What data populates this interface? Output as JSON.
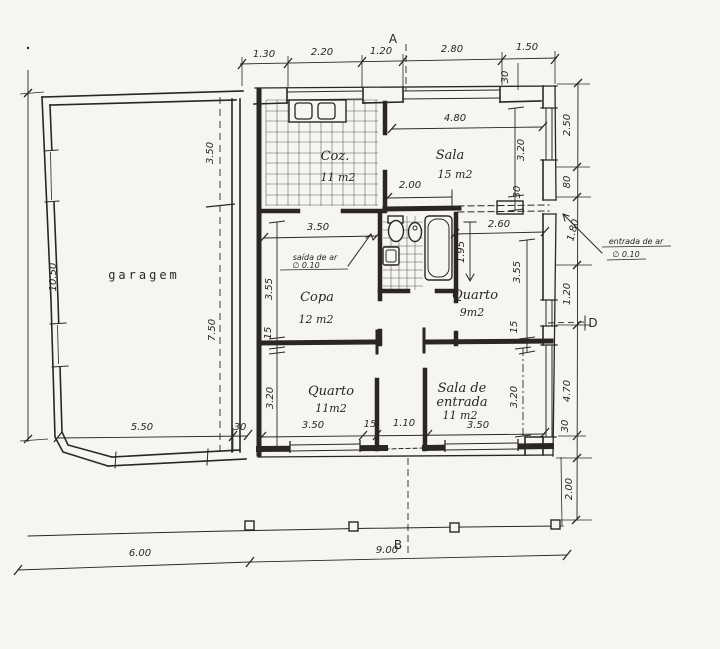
{
  "sheet": {
    "background": "#f6f5f0",
    "ink": "#2a2722"
  },
  "markers": {
    "a": "A",
    "b": "B",
    "d": "D"
  },
  "rooms": {
    "garagem": {
      "name": "garagem"
    },
    "coz": {
      "name": "Coz.",
      "area": "11 m2"
    },
    "sala": {
      "name": "Sala",
      "area": "15 m2"
    },
    "copa": {
      "name": "Copa",
      "area": "12 m2"
    },
    "quarto9": {
      "name": "Quarto",
      "area": "9m2"
    },
    "quarto11": {
      "name": "Quarto",
      "area": "11m2"
    },
    "sala_entrada": {
      "name_line1": "Sala de",
      "name_line2": "entrada",
      "area": "11 m2"
    }
  },
  "vents": {
    "saida_label": "saída de ar",
    "saida_size": "∅ 0.10",
    "entrada_label": "entrada de ar",
    "entrada_size": "∅ 0.10"
  },
  "dims": {
    "top": [
      "1.30",
      "2.20",
      "1.20",
      "2.80",
      "1.50"
    ],
    "top_wall": "30",
    "right": [
      "2.50",
      "80",
      "1.80",
      "1.20",
      "4.70",
      "2.00"
    ],
    "right_wall": "30",
    "left_height": "10.50",
    "garage": {
      "front": "3.50",
      "back": "7.50",
      "width": "5.50",
      "wall": "30"
    },
    "bottom_left": "6.00",
    "bottom_right": "9.00",
    "sala": {
      "width": "4.80",
      "part": "2.00",
      "height": "3.20",
      "wall": "30"
    },
    "copa": {
      "width": "3.50",
      "height": "3.55",
      "wall": "15"
    },
    "vestibule": {
      "width": "2.60"
    },
    "bath": {
      "depth": "1.95"
    },
    "quarto9": {
      "height": "3.55",
      "wall": "15"
    },
    "quarto11": {
      "height": "3.20",
      "width": "3.50",
      "wall": "15"
    },
    "corridor": {
      "width": "1.10"
    },
    "entrada_room": {
      "width": "3.50",
      "height": "3.20",
      "wall": "30"
    }
  }
}
